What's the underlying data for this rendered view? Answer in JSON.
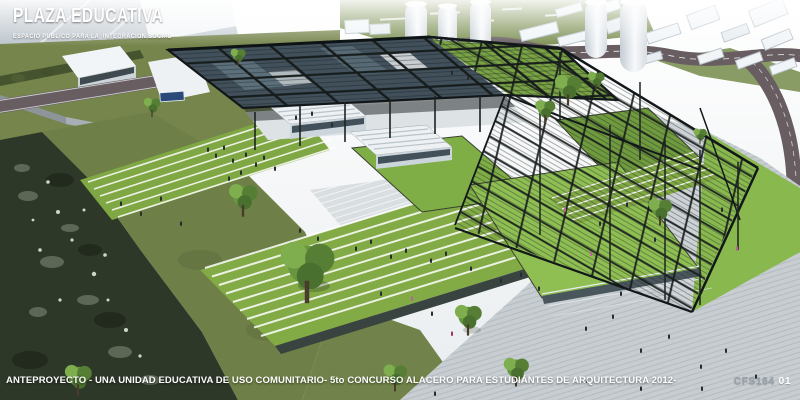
{
  "header": {
    "title": "PLAZA EDUCATIVA",
    "subtitle": "ESPACIO PUBLICO PARA LA  INTEGRACION SOCIAL"
  },
  "footer": {
    "caption": "ANTEPROYECTO - UNA UNIDAD EDUCATIVA DE USO COMUNITARIO- 5to CONCURSO ALACERO PARA ESTUDIÁNTES DE ARQUITECTURA 2012-",
    "project_code": "CFS164",
    "sheet_number": "01"
  },
  "palette": {
    "steel": "#1d2321",
    "glass_roof": "#41505b",
    "lawn": "#7fae46",
    "lawn_bright": "#8fbf52",
    "grass_olive": "#76854c",
    "river": "#2e3829",
    "plaza_paving": "#c7cdd1",
    "steps_white": "#edf0f2",
    "road": "#685e62",
    "building_white": "#f2f5f7",
    "building_shade": "#c2ccd4",
    "text_white": "#ffffff",
    "code_gray": "#9aa1a9"
  }
}
